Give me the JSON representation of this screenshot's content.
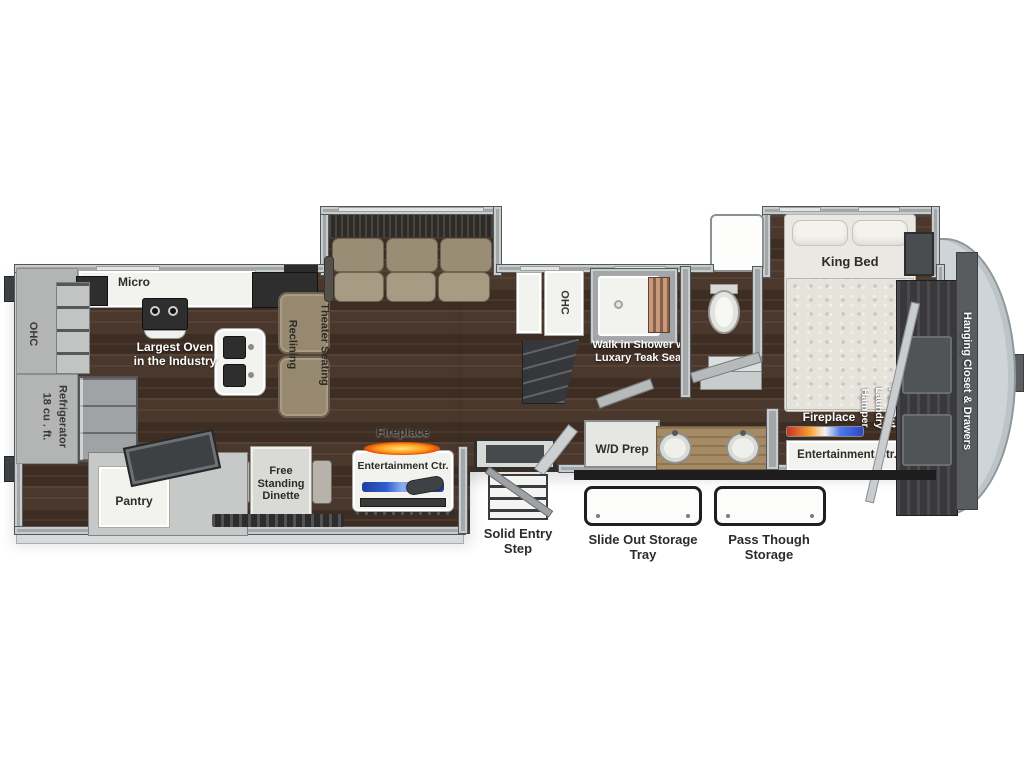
{
  "title": "Fifth Wheel RV Floor Plan",
  "kitchen": {
    "micro": "Micro",
    "ohc": "OHC",
    "oven": "Largest Oven\nin the Industry",
    "refrigerator_size": "18 cu . ft.",
    "refrigerator_name": "Refrigerator",
    "pantry": "Pantry"
  },
  "living": {
    "theater_col_left": "Reclining",
    "theater_col_right": "Theater Seating",
    "dinette": "Free\nStanding\nDinette",
    "fireplace": "Fireplace",
    "entertainment": "Entertainment Ctr."
  },
  "entry": {
    "step": "Solid Entry\nStep"
  },
  "bath": {
    "ohc": "OHC",
    "shower": "Walk in Shower w/\nLuxary Teak Seat",
    "wd_prep": "W/D Prep"
  },
  "bedroom": {
    "king_bed": "King Bed",
    "fireplace": "Fireplace",
    "entertainment": "Entertainment Ctr.",
    "hamper": "Pull Out\nLaundry\nHamper",
    "closet": "Hanging Closet & Drawers"
  },
  "storage": {
    "slide_tray": "Slide Out Storage\nTray",
    "pass_through": "Pass Though\nStorage"
  },
  "colors": {
    "floor_wood": "#46342a",
    "wall_gray": "#a4a7a9",
    "cabinet_white": "#f2f2ef",
    "seating_tan": "#96896f",
    "mattress": "#eae8e2",
    "fireplace_glow": "#ff8c00",
    "tv_stripe_blue": "#2f5fd0",
    "front_cap": "#ced4d7",
    "closet_dark": "#39393b",
    "label_dark": "#2e2b28",
    "label_light": "#ffffff"
  }
}
